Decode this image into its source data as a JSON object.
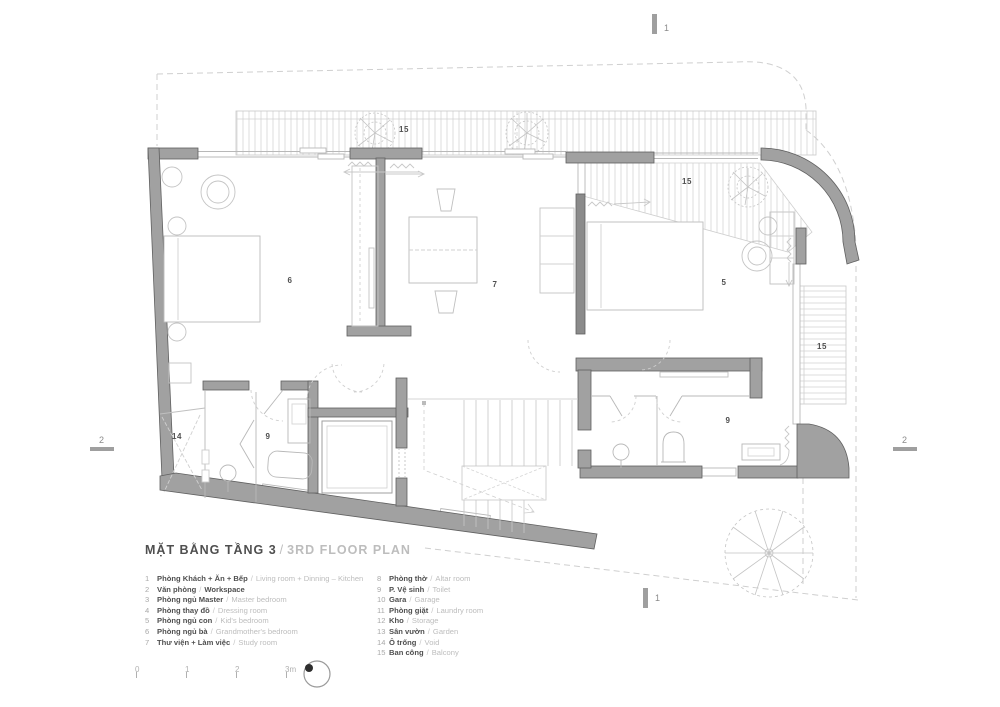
{
  "header": {
    "title_vi": "MẶT BẰNG TẦNG 3",
    "sep": "/",
    "title_en": "3RD FLOOR PLAN"
  },
  "legend": {
    "sep": "/",
    "items": [
      {
        "num": "1",
        "vi": "Phòng Khách + Ăn + Bếp",
        "en": "Living room + Dinning – Kitchen"
      },
      {
        "num": "2",
        "vi": "Văn phòng",
        "en": "Workspace"
      },
      {
        "num": "3",
        "vi": "Phòng ngủ Master",
        "en": "Master bedroom"
      },
      {
        "num": "4",
        "vi": "Phòng thay đồ",
        "en": "Dressing room"
      },
      {
        "num": "5",
        "vi": "Phòng ngủ con",
        "en": "Kid's bedroom"
      },
      {
        "num": "6",
        "vi": "Phòng ngủ bà",
        "en": "Grandmother's bedroom"
      },
      {
        "num": "7",
        "vi": "Thư viện + Làm việc",
        "en": "Study room"
      },
      {
        "num": "8",
        "vi": "Phòng thờ",
        "en": "Altar room"
      },
      {
        "num": "9",
        "vi": "P. Vệ sinh",
        "en": "Toilet"
      },
      {
        "num": "10",
        "vi": "Gara",
        "en": "Garage"
      },
      {
        "num": "11",
        "vi": "Phòng giặt",
        "en": "Laundry room"
      },
      {
        "num": "12",
        "vi": "Kho",
        "en": "Storage"
      },
      {
        "num": "13",
        "vi": "Sân vườn",
        "en": "Garden"
      },
      {
        "num": "14",
        "vi": "Ô trống",
        "en": "Void"
      },
      {
        "num": "15",
        "vi": "Ban công",
        "en": "Balcony"
      }
    ]
  },
  "plan": {
    "labels": [
      {
        "text": "15"
      },
      {
        "text": "15"
      },
      {
        "text": "15"
      },
      {
        "text": "6"
      },
      {
        "text": "7"
      },
      {
        "text": "5"
      },
      {
        "text": "14"
      },
      {
        "text": "9"
      },
      {
        "text": "9"
      }
    ],
    "markers": {
      "top": "1",
      "bottom": "1",
      "left": "2",
      "right": "2"
    }
  },
  "scalebar": {
    "labels": [
      "0",
      "1",
      "2",
      "3m"
    ]
  },
  "colors": {
    "wall": "#a1a1a1",
    "wall_edge": "#606060",
    "thin_line": "#b8b8b8",
    "dash": "#cfcfcf",
    "hatch": "#dedede",
    "text_dark": "#4f4f4f",
    "text_light": "#bdbdbd"
  }
}
